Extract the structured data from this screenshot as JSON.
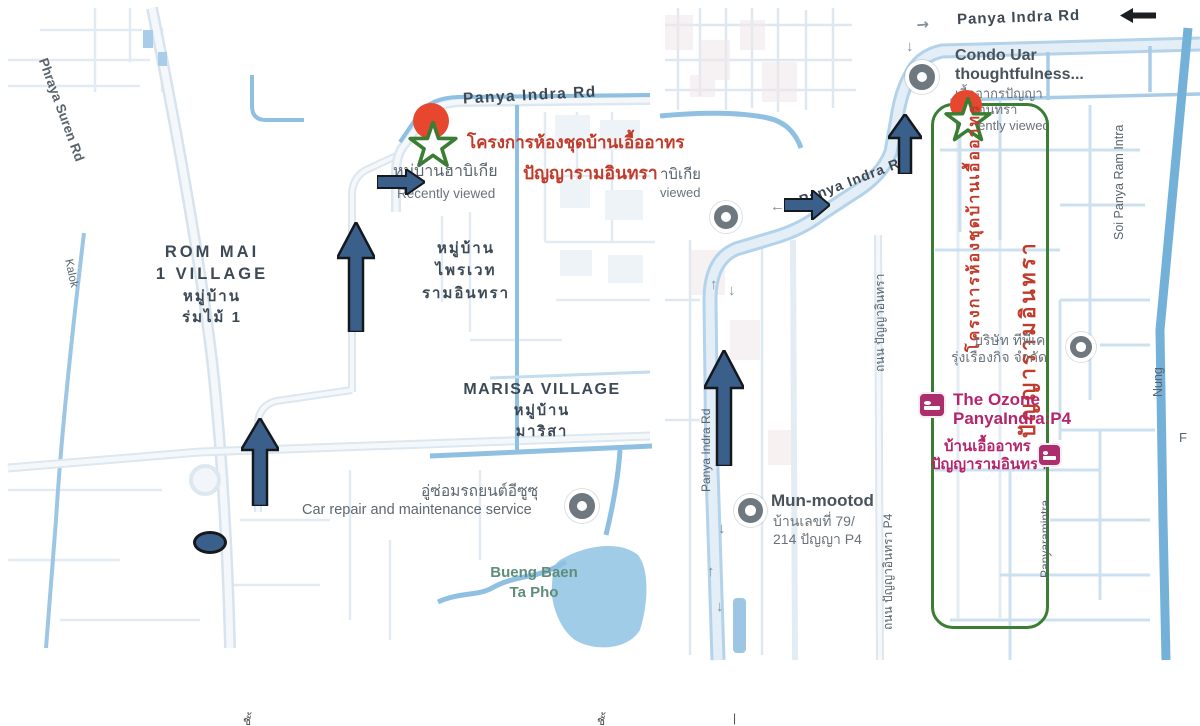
{
  "left_map": {
    "road_labels": {
      "phraya_suren": "Phraya Suren Rd",
      "kalok": "Kalok",
      "panya_indra": "Panya Indra Rd"
    },
    "destination": {
      "line1": "โครงการห้องชุดบ้านเอื้ออาทร",
      "line2": "ปัญญารามอินทรา"
    },
    "habitia": {
      "name": "หมู่บ้านฮาบิเกีย",
      "status": "Recently viewed"
    },
    "rom_mai": {
      "l1": "ROM MAI",
      "l2": "1 VILLAGE",
      "l3": "หมู่บ้าน",
      "l4": "ร่มไม้ 1"
    },
    "private_ramintra": {
      "l1": "หมู่บ้าน",
      "l2": "ไพรเวท",
      "l3": "รามอินทรา"
    },
    "marisa": {
      "l1": "MARISA VILLAGE",
      "l2": "หมู่บ้าน",
      "l3": "มาริสา"
    },
    "car_repair": {
      "th": "อู่ซ่อมรถยนต์อีซูซุ",
      "en": "Car repair and maintenance service"
    },
    "water": {
      "l1": "Bueng Baen",
      "l2": "Ta Pho"
    }
  },
  "right_map": {
    "top_road": "Panya Indra Rd",
    "curve_road": "Panya Indra Rd",
    "condo": {
      "l1": "Condo Uar",
      "l2": "thoughtfulness...",
      "l3": "เอื้ออากรปัญญา",
      "l4": "รามอินทรา",
      "l5": "Recently viewed"
    },
    "edge_cut": {
      "l1": "าบิเกีย",
      "l2": "viewed"
    },
    "annotation": {
      "vertical1": "โครงการห้องชุดบ้านเอื้ออาทร",
      "vertical2": "ปัญญารามอินทรา"
    },
    "company": {
      "l1": "บริษัท ทีพีเค",
      "l2": "รุ่งเรืองกิจ จำกัด"
    },
    "ozone": {
      "l1": "The Ozone",
      "l2": "PanyaIndra:P4"
    },
    "baan": {
      "l1": "บ้านเอื้ออาทร",
      "l2": "ปัญญารามอินทรา"
    },
    "mun": {
      "l1": "Mun-mootod",
      "l2": "บ้านเลขที่ 79/",
      "l3": "214 ปัญญา P4"
    },
    "soi_panya": "Soi Panya Ram Intra",
    "panyaramintra": "Panyaramintra",
    "nung": "Nung",
    "f_label": "F",
    "street_p4_upper": "ถนน ปัญญาอินทรา",
    "street_p4_lower": "ถนน ปัญญาอินทรา P4",
    "left_road_vertical": "Panya Indra Rd"
  },
  "bottom_fragments": {
    "f1": "ชั้",
    "f2": "ชั้",
    "f3": "|"
  },
  "colors": {
    "route_arrow": "#3a5f8a",
    "annotation_red": "#c13b2a",
    "poi_pink": "#ad2e6d",
    "highlight_green": "#3a7d33",
    "water_blue": "#8fc0e2",
    "destination_marker_red": "#e8472f"
  }
}
